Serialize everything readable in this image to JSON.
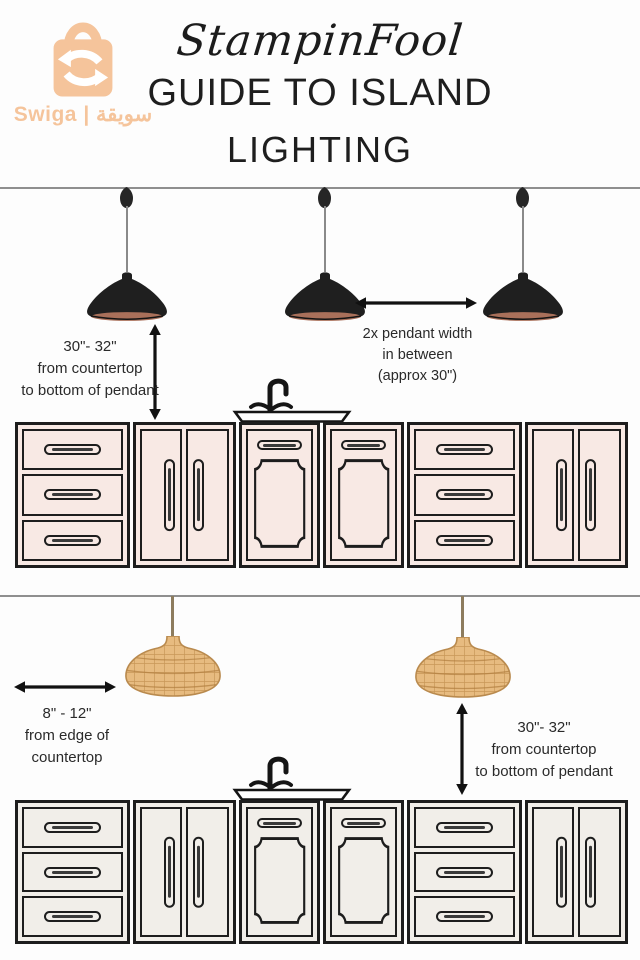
{
  "watermark": {
    "label": "Swiga | سويقة",
    "color": "#f5c49b"
  },
  "header": {
    "brand": "StampinFool",
    "title_line1": "GUIDE TO ISLAND",
    "title_line2": "LIGHTING"
  },
  "section_pendants": {
    "height_note": [
      "30\"- 32\"",
      "from countertop",
      "to bottom of pendant"
    ],
    "spacing_note": [
      "2x pendant width",
      "in between",
      "(approx 30\")"
    ]
  },
  "section_wicker": {
    "edge_note": [
      "8\" - 12\"",
      "from edge of",
      "countertop"
    ],
    "height_note": [
      "30\"- 32\"",
      "from countertop",
      "to bottom of pendant"
    ]
  },
  "cabinet_rows": {
    "top": {
      "fill": "#f8e9e4",
      "units": [
        "drawers",
        "doors",
        "panel",
        "panel",
        "drawers",
        "doors"
      ]
    },
    "bottom": {
      "fill": "#f1eee9",
      "units": [
        "drawers",
        "doors",
        "panel",
        "panel",
        "drawers",
        "doors"
      ]
    }
  },
  "colors": {
    "accent_orange": "#f5c49b",
    "outline_black": "#1d1d1d",
    "ceiling_gray": "#8f8f8f",
    "pendant_black": "#1f1f1f",
    "pendant_copper": "#a9705a",
    "wicker_tan": "#e7bb80",
    "wicker_line": "#bd8a4a",
    "text_dark": "#2a2a2a"
  }
}
